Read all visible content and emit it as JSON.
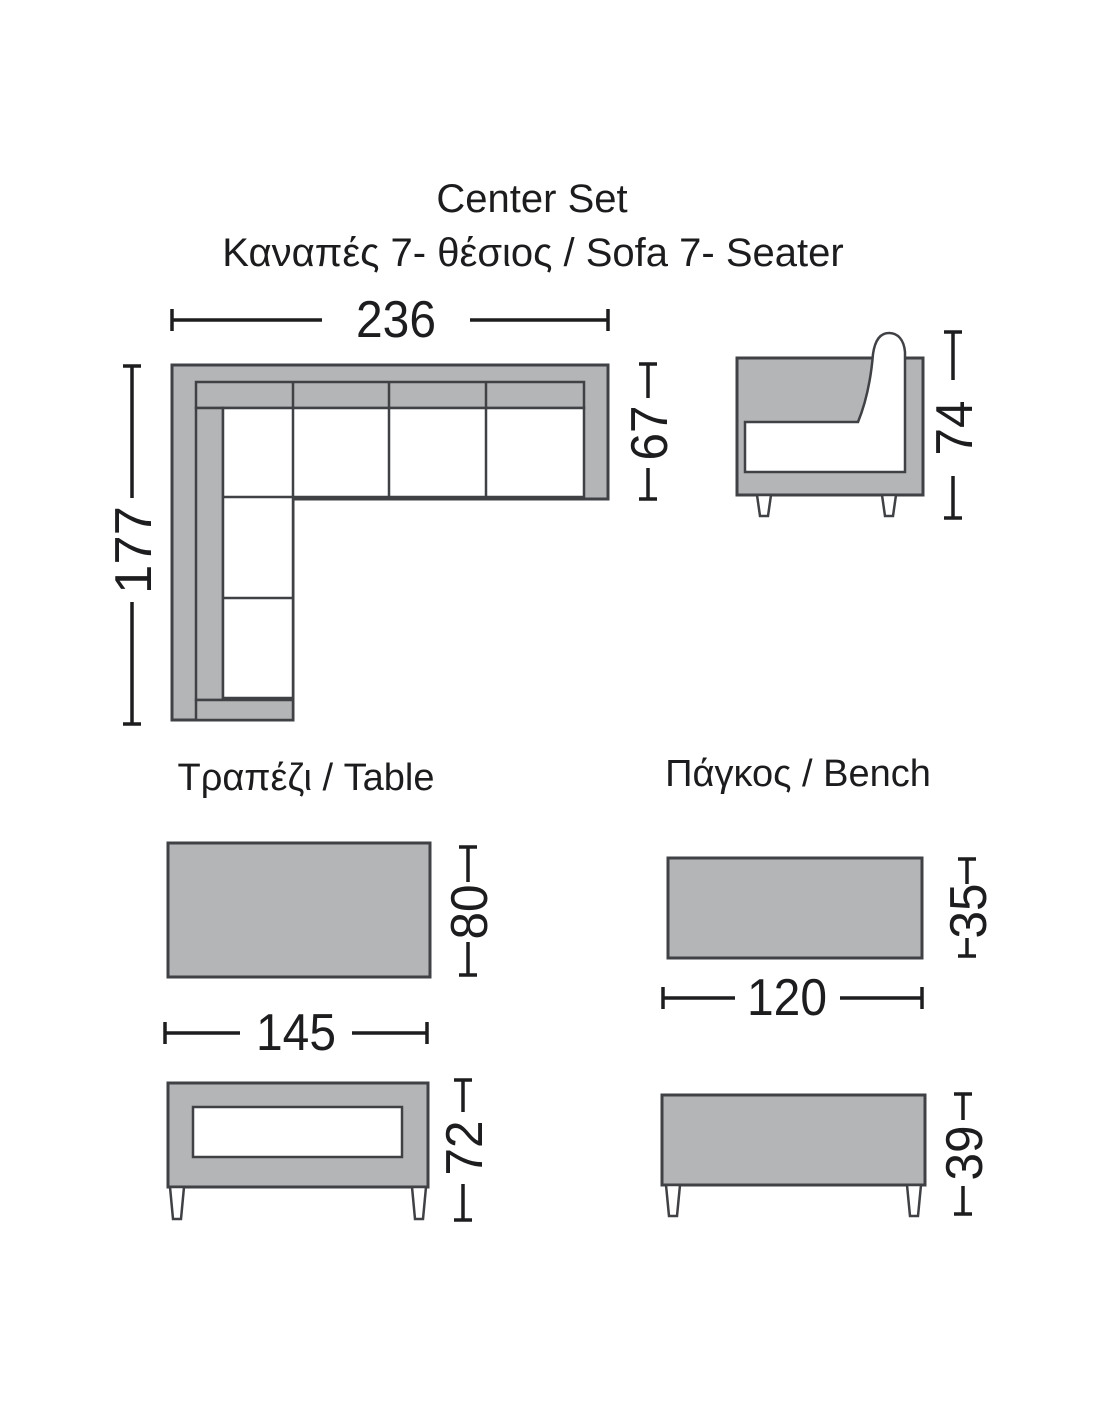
{
  "colors": {
    "background": "#ffffff",
    "shape_fill": "#b3b5b7",
    "shape_outline": "#3f4145",
    "dimension_color": "#1d1d1f"
  },
  "header": {
    "title": "Center Set",
    "subtitle": "Καναπές 7- θέσιος / Sofa 7- Seater"
  },
  "sofa": {
    "plan": {
      "width": "236",
      "depth": "67",
      "length": "177"
    },
    "side": {
      "height": "74"
    }
  },
  "table": {
    "label": "Τραπέζι / Table",
    "top": {
      "length": "145",
      "depth": "80"
    },
    "side": {
      "height": "72"
    }
  },
  "bench": {
    "label": "Πάγκος / Bench",
    "top": {
      "length": "120",
      "depth": "35"
    },
    "side": {
      "height": "39"
    }
  }
}
